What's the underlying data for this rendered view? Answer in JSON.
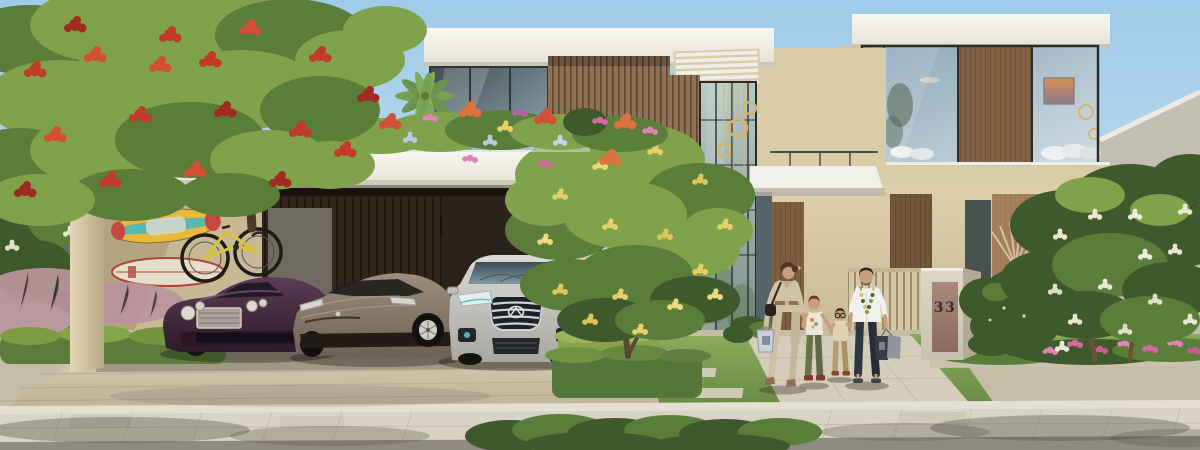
{
  "scene": {
    "title": "Modern villa exterior - architectural rendering",
    "setting": "Daytime street view of a contemporary two-storey villa with carport, roof terrace, landscaped garden and a family of four walking past on the sidewalk",
    "address_number": "33"
  },
  "palette": {
    "sky_top": "#9ecbe9",
    "sky_bottom": "#d8e9f3",
    "roof_white": "#f4f3ee",
    "wall_beige": "#d8caa6",
    "wood_mid": "#8f7254",
    "wood_dark": "#33291f",
    "wood_warm": "#a9805c",
    "glass_cool": "#9db4c2",
    "gold": "#d6b36a",
    "green_light": "#7fa24b",
    "green_mid": "#5a7d3a",
    "green_dark": "#3e5a2c",
    "flame_red": "#c23a2a",
    "flower_yellow": "#e6cf6a",
    "flower_white": "#ebe7d4",
    "flower_pink": "#d6699f",
    "lawn_green": "#7d9b51",
    "paver_beige": "#cdc1a8",
    "sidewalk_gray": "#d8d3c5",
    "road_gray": "#908c84",
    "stone_light": "#d8d1c1",
    "bronze_panel": "#a08070",
    "address_text": "#332e29",
    "bentley_purple": "#3b2136",
    "tesla_bronze": "#8d7e6c",
    "infiniti_silver": "#c9c7c2",
    "skin_tan": "#c79f7e",
    "navy_pants": "#2f3542"
  },
  "architecture": {
    "style": "modern flat-roof villa, two storeys",
    "features": [
      "white flat roof slabs with louvered pergola",
      "floor-to-ceiling glazing with black mullions",
      "vertical timber slat panels",
      "double-height glass entry with gold ring pendant lights",
      "roof terrace with flower planters and palm",
      "three-bay carport",
      "timber privacy fence",
      "stone address pillar with bronze plaque"
    ],
    "address_sign": {
      "number": "33"
    }
  },
  "vehicles": [
    {
      "name": "purple luxury coupe",
      "color": "#3b2136",
      "position": "carport left bay"
    },
    {
      "name": "bronze electric sedan",
      "color": "#8d7e6c",
      "position": "carport middle bay"
    },
    {
      "name": "silver luxury SUV",
      "color": "#c9c7c2",
      "position": "carport right bay"
    }
  ],
  "people": [
    {
      "name": "woman",
      "outfit": "beige jumpsuit, black crossbody bag, light shopping bag, wedge heels"
    },
    {
      "name": "older boy",
      "outfit": "white graphic t-shirt, green trousers, dark red shoes"
    },
    {
      "name": "younger boy",
      "outfit": "round glasses, cream shirt, khaki trousers, sandals"
    },
    {
      "name": "man",
      "outfit": "white shirt with patterned scarf, navy trousers, sandals, two shopping bags"
    }
  ],
  "gear": [
    "colorful wall-mounted surfboard",
    "cream wall-mounted surfboard",
    "yellow wall-mounted bicycle"
  ],
  "vegetation": [
    "flame tree with red blossoms (left foreground)",
    "green tree with yellow blossoms (center, at entrance)",
    "plumeria trees with white blossoms (right)",
    "roof terrace flower planters (pink, red, orange, purple)",
    "palm fronds on terrace",
    "clipped box hedges",
    "pink muhly ornamental grass",
    "pink flower bed along right lawn"
  ]
}
